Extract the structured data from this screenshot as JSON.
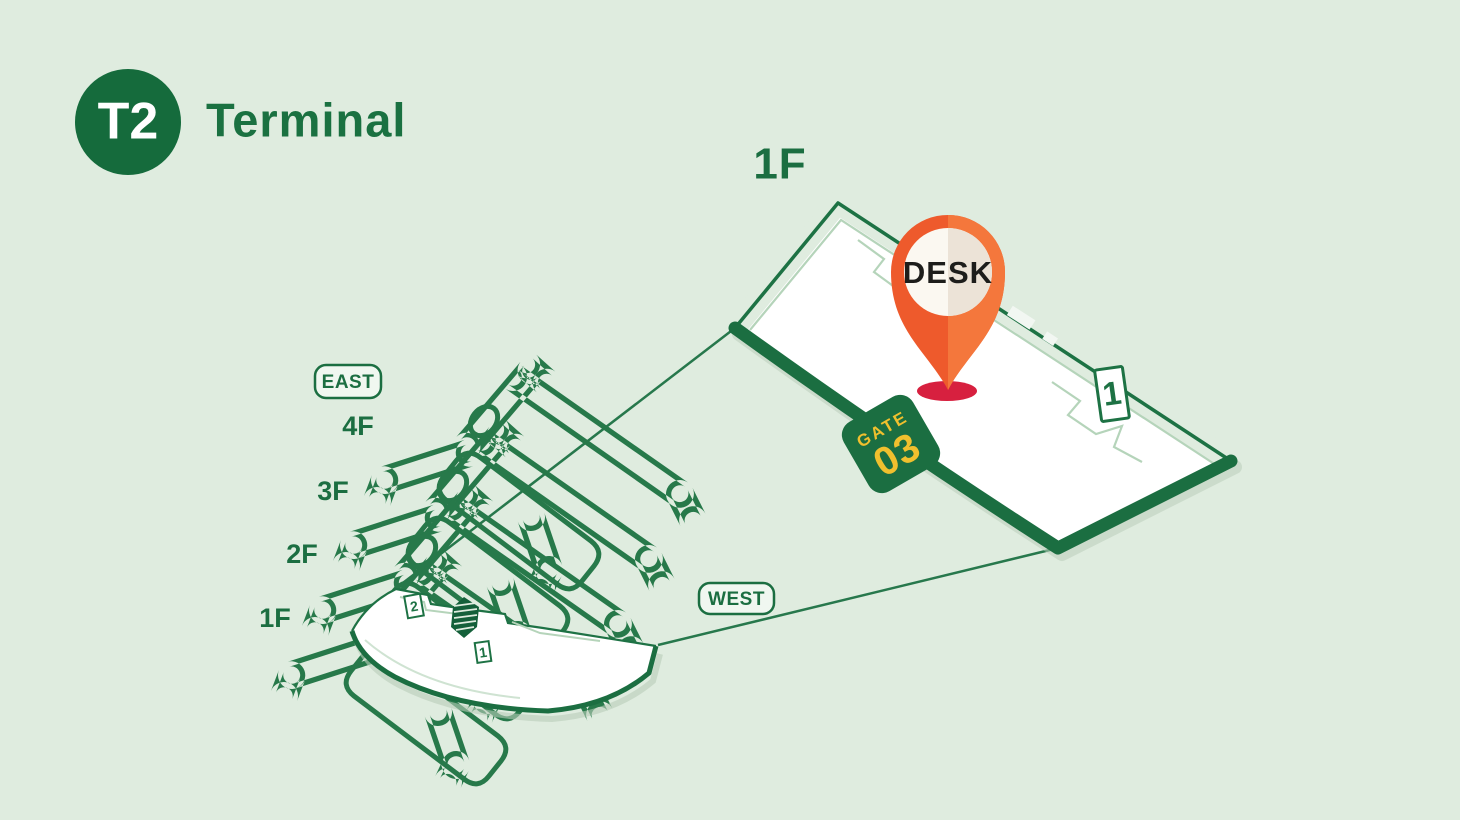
{
  "header": {
    "terminal_badge": "T2",
    "title": "Terminal"
  },
  "detail_view": {
    "floor_label": "1F",
    "desk_pin_label": "DESK",
    "gate_badge": {
      "label": "GATE",
      "number": "03"
    },
    "area_marker": "1"
  },
  "building_view": {
    "east_label": "EAST",
    "west_label": "WEST",
    "floor_labels": [
      "4F",
      "3F",
      "2F",
      "1F"
    ],
    "mini_marker_2": "2",
    "mini_marker_1": "1"
  },
  "colors": {
    "background": "#dfecdf",
    "dark_green": "#1b6e41",
    "outline_green": "#27794a",
    "light_inner_line": "#b5d4ba",
    "gold": "#f0c02e",
    "pin_orange_left": "#ee5a2c",
    "pin_orange_right": "#f4773c",
    "pin_inner_left": "#fbf8f1",
    "pin_inner_right": "#ece3d7",
    "pin_shadow_red": "#d7203f"
  }
}
